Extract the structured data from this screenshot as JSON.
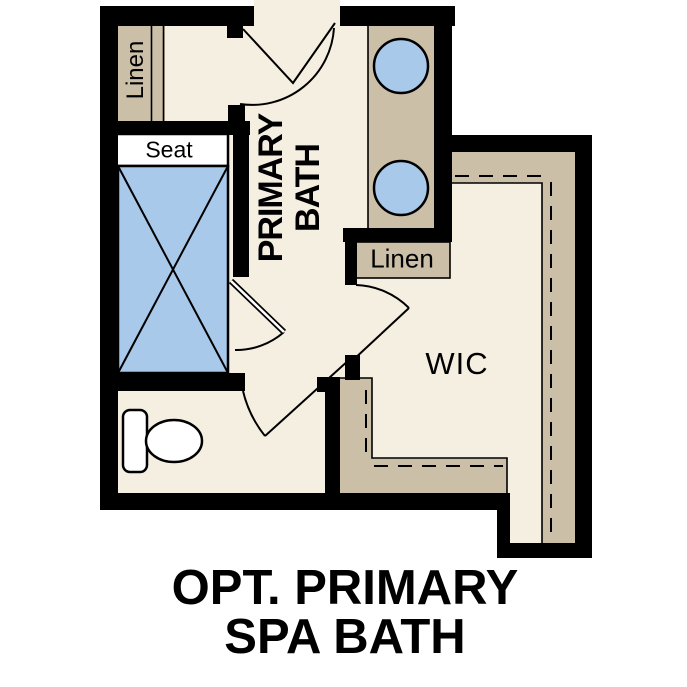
{
  "title": {
    "line1": "OPT. PRIMARY",
    "line2": "SPA BATH"
  },
  "rooms": {
    "primary_bath": {
      "line1": "PRIMARY",
      "line2": "BATH"
    },
    "wic": {
      "label": "WIC"
    }
  },
  "labels": {
    "linen_top_left": "Linen",
    "linen_middle": "Linen",
    "shower_seat": "Seat"
  },
  "colors": {
    "floor": "#f5efe2",
    "tan": "#cbbfa8",
    "blue": "#a8c9ea",
    "wall": "#000000"
  }
}
